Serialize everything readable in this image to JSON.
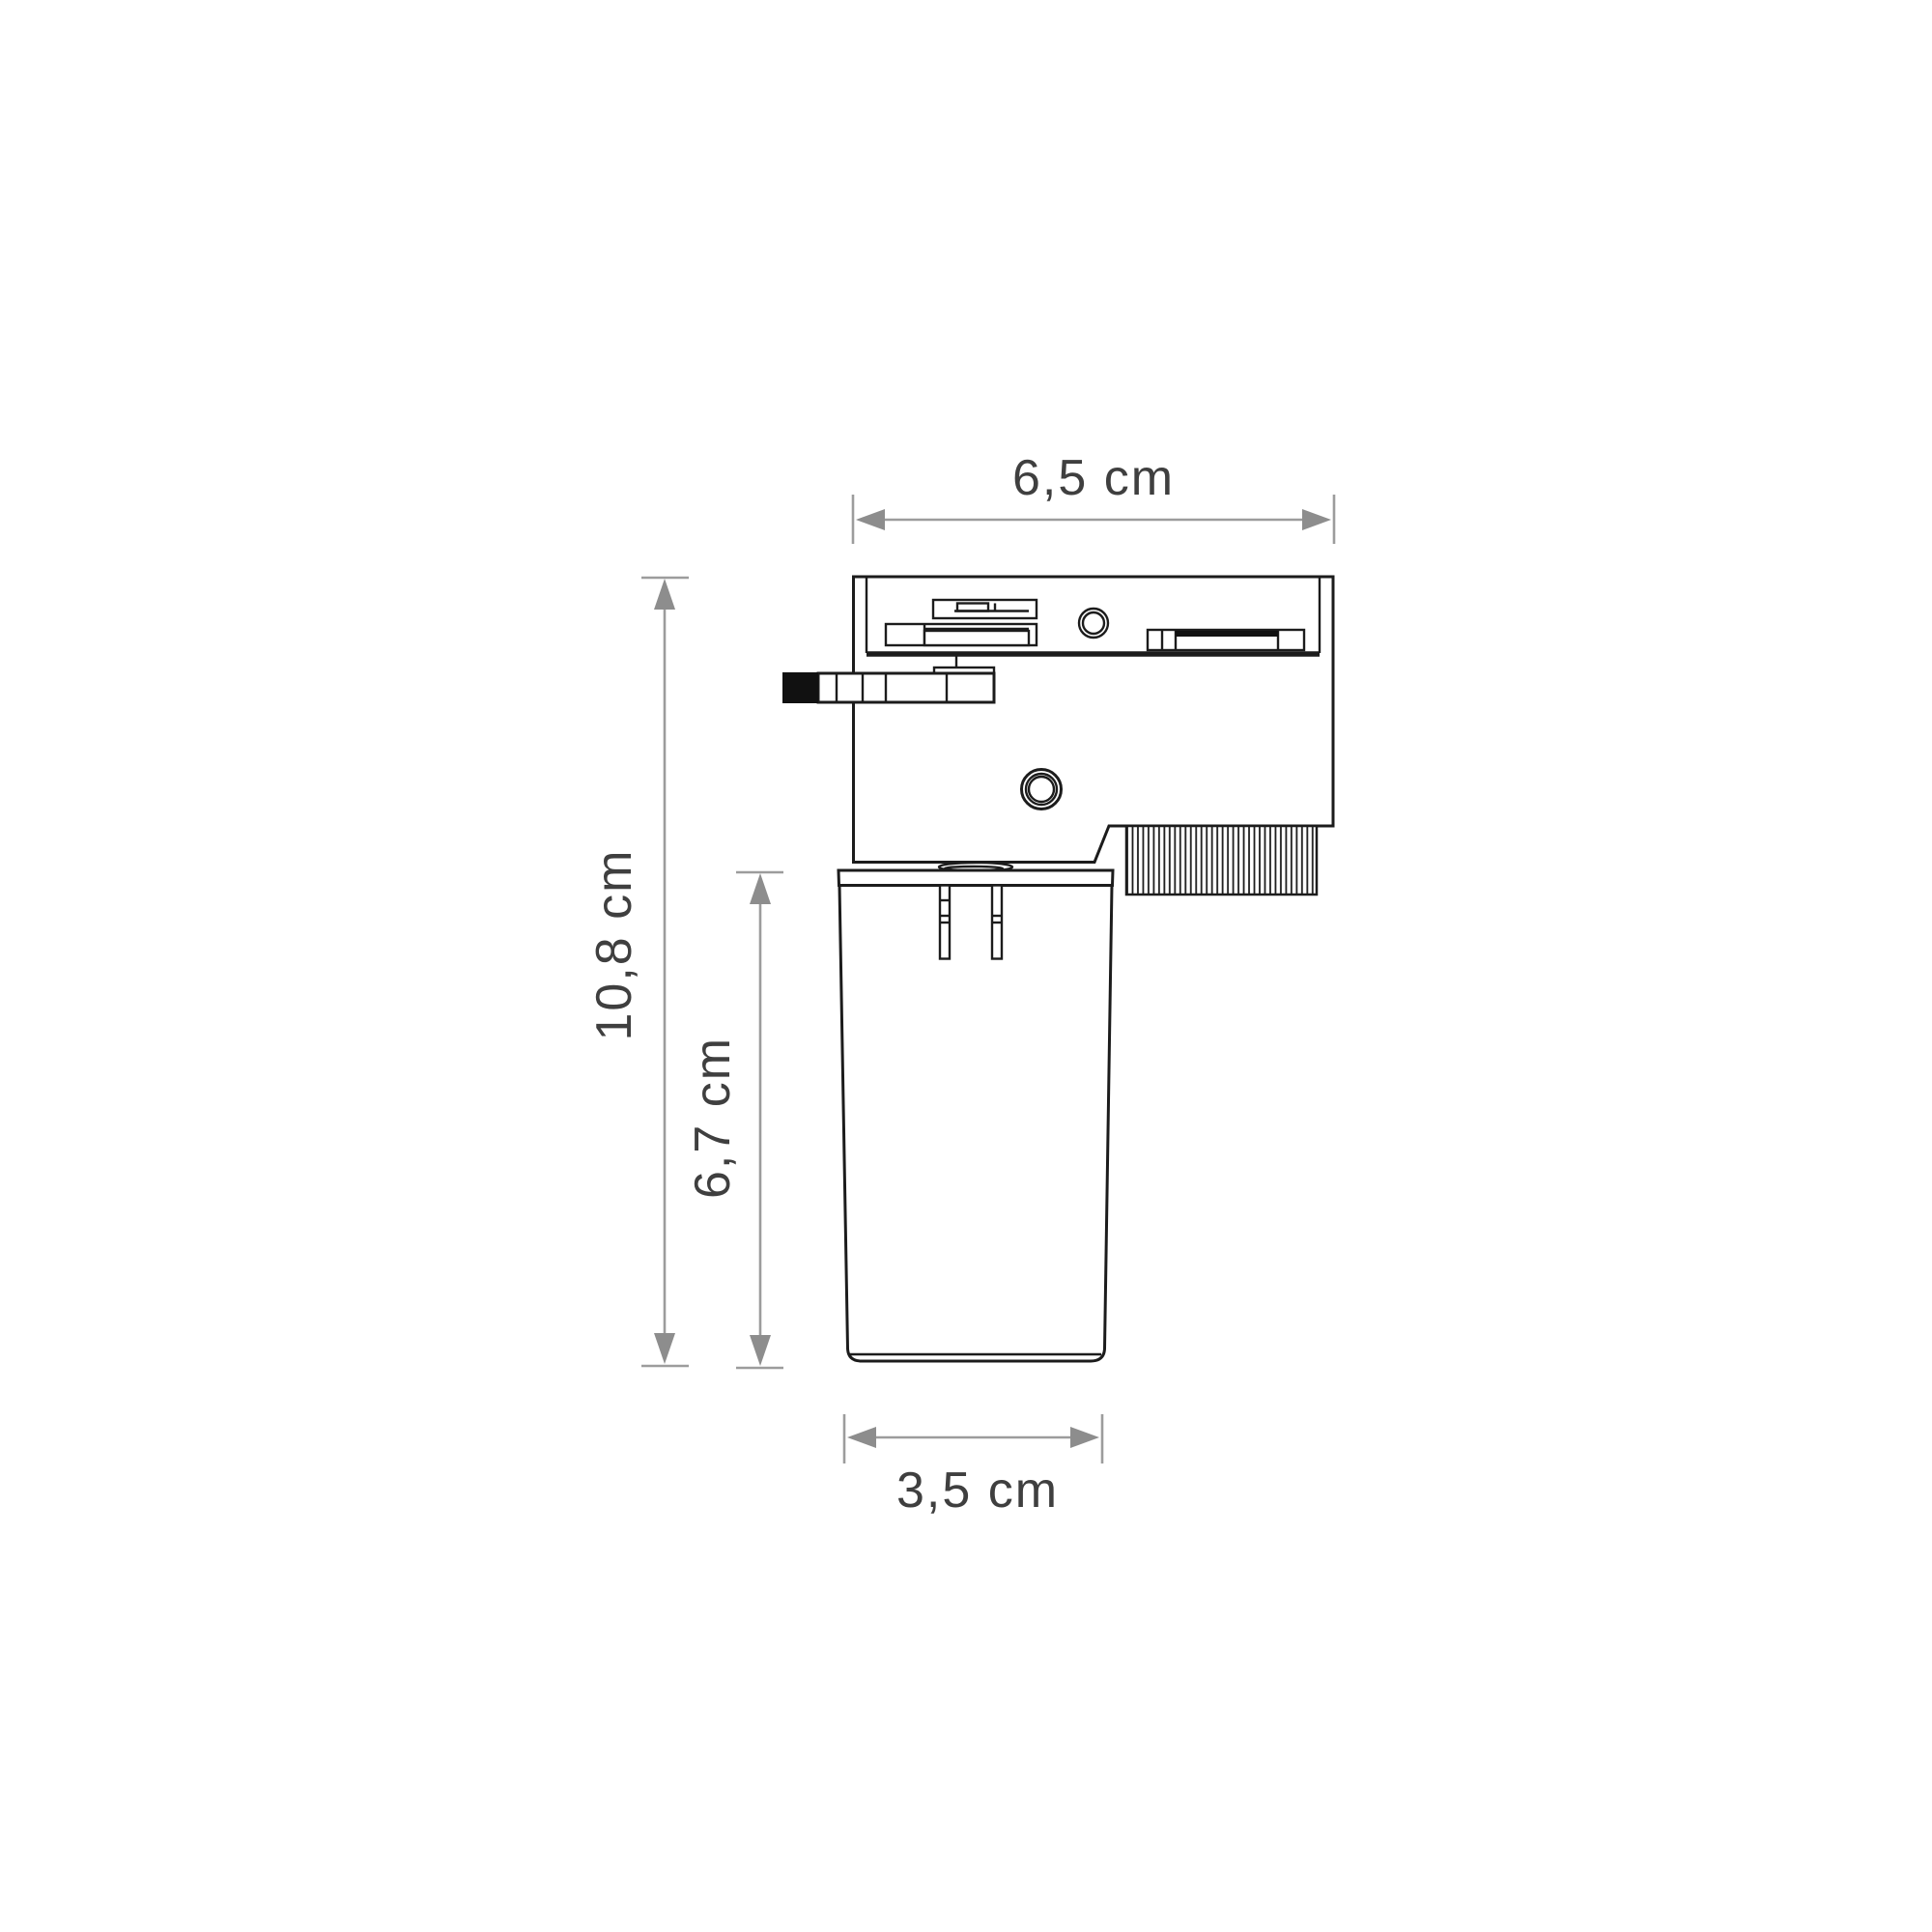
{
  "drawing": {
    "title": "track-light adapter dimension drawing",
    "dimensions": {
      "top_width": {
        "label": "6,5 cm"
      },
      "total_height": {
        "label": "10,8 cm"
      },
      "lamp_height": {
        "label": "6,7 cm"
      },
      "bottom_width": {
        "label": "3,5 cm"
      }
    },
    "colors": {
      "outline": "#1c1c1c",
      "dimension_line": "#9c9c9c",
      "dimension_arrow": "#8d8d8d",
      "dimension_text": "#3f3f3f",
      "background": "#ffffff"
    }
  }
}
